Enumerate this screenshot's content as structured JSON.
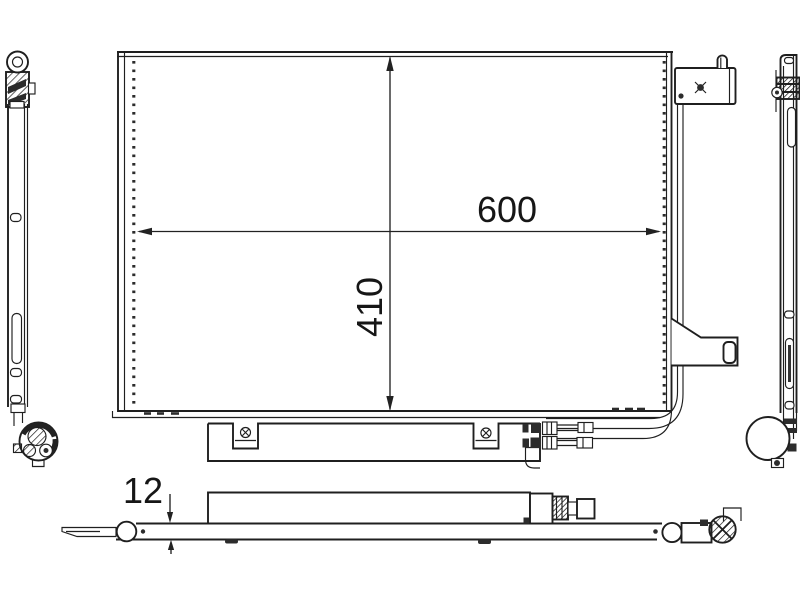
{
  "page": {
    "background_color": "#ffffff",
    "line_color": "#1f1f1f",
    "text_color": "#161616"
  },
  "drawing": {
    "type": "technical-drawing",
    "subject": "air-conditioning condenser, orthographic views",
    "views": {
      "front": "front-view",
      "left": "left-side-view",
      "right": "right-side-view",
      "bottom": "bottom-view"
    }
  },
  "dimensions": {
    "core_width": {
      "label": "600",
      "orientation": "horizontal"
    },
    "core_height": {
      "label": "410",
      "orientation": "vertical"
    },
    "core_depth": {
      "label": "12",
      "orientation": "vertical"
    }
  }
}
